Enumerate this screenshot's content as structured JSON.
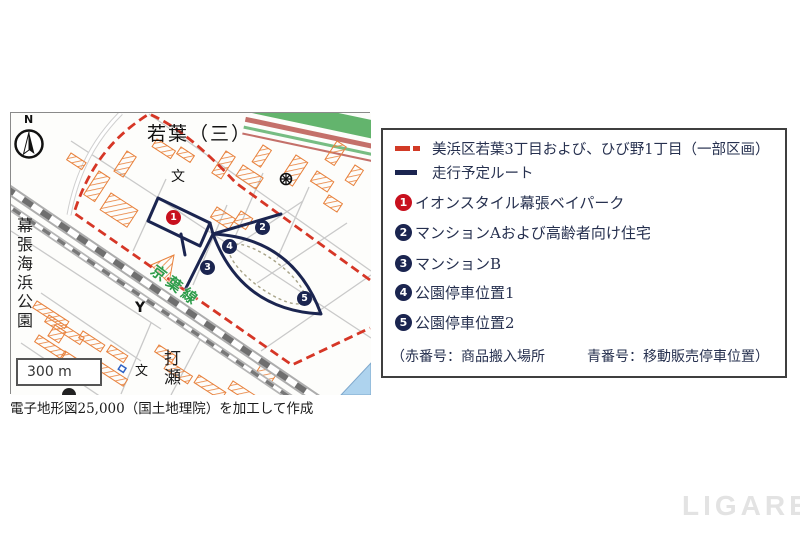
{
  "page": {
    "watermark": "LIGARE"
  },
  "map": {
    "compass": "N",
    "scale": "300 m",
    "caption": "電子地形図25,000（国土地理院）を加工して作成",
    "labels": {
      "district": "若葉（三）",
      "rail_line": "京葉線",
      "park": "幕張海浜公園",
      "town": "打瀬",
      "school1": "文",
      "school2": "文",
      "fire_station": "Y"
    },
    "markers": [
      {
        "num": "1"
      },
      {
        "num": "2"
      },
      {
        "num": "3"
      },
      {
        "num": "4"
      },
      {
        "num": "5"
      }
    ],
    "colors": {
      "boundary": "#d63626",
      "route": "#1b2550",
      "marker_red": "#c8101e",
      "marker_navy": "#1b2550"
    }
  },
  "legend": {
    "boundary_label": "美浜区若葉3丁目および、ひび野1丁目（一部区画）",
    "route_label": "走行予定ルート",
    "items": [
      {
        "num": "1",
        "label": "イオンスタイル幕張ベイパーク"
      },
      {
        "num": "2",
        "label": "マンションAおよび高齢者向け住宅"
      },
      {
        "num": "3",
        "label": "マンションB"
      },
      {
        "num": "4",
        "label": "公園停車位置1"
      },
      {
        "num": "5",
        "label": "公園停車位置2"
      }
    ],
    "note": "（赤番号：商品搬入場所　　　青番号：移動販売停車位置）"
  }
}
